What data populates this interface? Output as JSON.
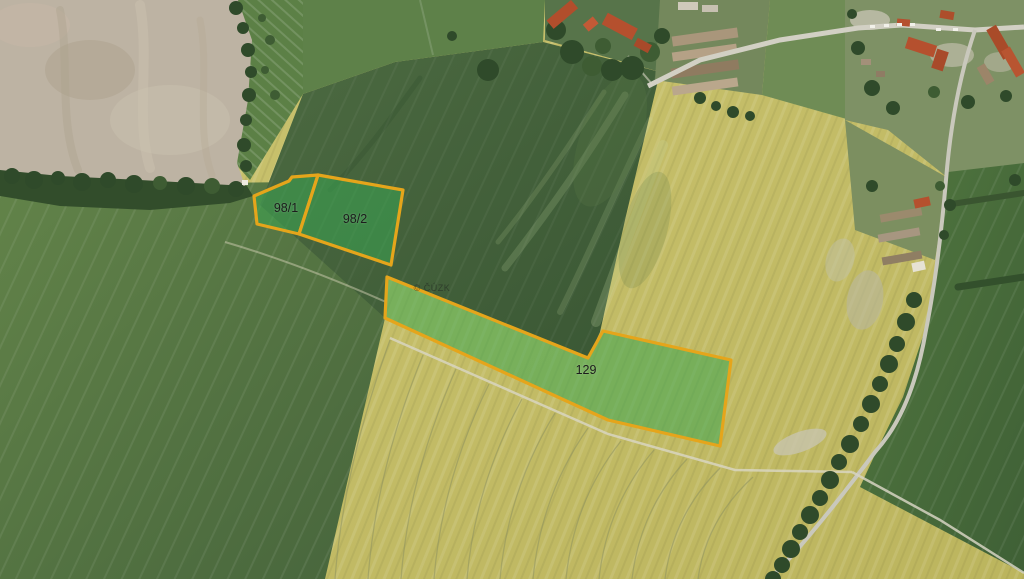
{
  "map": {
    "type": "aerial-cadastral-view",
    "watermark": "© ČÚZK",
    "colors": {
      "parcel_outline": "#E5A51B",
      "parcel_fill": "rgba(58,165,82,0.55)",
      "field_yellow": "#C5BE68",
      "field_dark_green": "#41603A",
      "field_green": "#5E8149",
      "woodland": "#324D2B",
      "bare_soil": "#BDB3A3",
      "road": "#D2D0C4"
    },
    "parcels": [
      {
        "id": "98/1",
        "label": "98/1",
        "points": "254,196 289,181 292,177 318,175 299,234 257,224"
      },
      {
        "id": "98/2",
        "label": "98/2",
        "points": "318,175 403,190 391,265 299,234"
      },
      {
        "id": "129",
        "label": "129",
        "points": "387,277 588,358 603,331 731,360 720,446 608,420 385,318"
      }
    ]
  }
}
